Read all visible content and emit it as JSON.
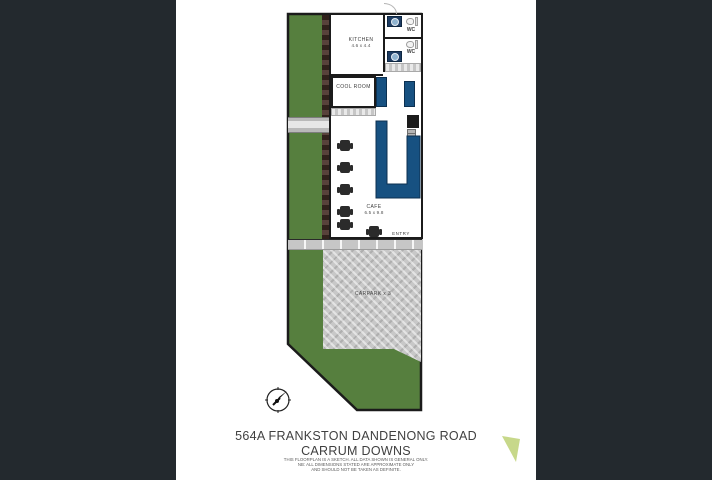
{
  "address": {
    "line1": "564A FRANKSTON DANDENONG ROAD",
    "line2": "CARRUM DOWNS"
  },
  "disclaimer": {
    "line1": "THIS FLOORPLAN IS A SKETCH. ALL DATA SHOWN IS GENERAL ONLY.",
    "line2": "NB: ALL DIMENSIONS STATED ARE APPROXIMATE ONLY",
    "line3": "AND SHOULD NOT BE TAKEN AS DEFINITE."
  },
  "floorplan": {
    "kitchen_label": "KITCHEN",
    "kitchen_dims": "4.6 x 4.4",
    "cool_room_label": "COOL ROOM",
    "cafe_label": "CAFE",
    "cafe_dims": "6.5 x 9.8",
    "entry_label": "ENTRY",
    "carpark_label": "CARPARK x 3",
    "wc1_label": "WC",
    "wc2_label": "WC"
  },
  "icons": {
    "compass": "compass-north-icon",
    "logo": "agency-logo-triangle-icon"
  },
  "colors": {
    "page_background": "#23292e",
    "plan_canvas": "#ffffff",
    "grass_green": "#567f3e",
    "counter_blue": "#175181",
    "wall_black": "#1b1b1b",
    "carpark_gray": "#c8c8c8",
    "garden_bed_brown": "#4a322a",
    "logo_green": "#c7d88a"
  }
}
